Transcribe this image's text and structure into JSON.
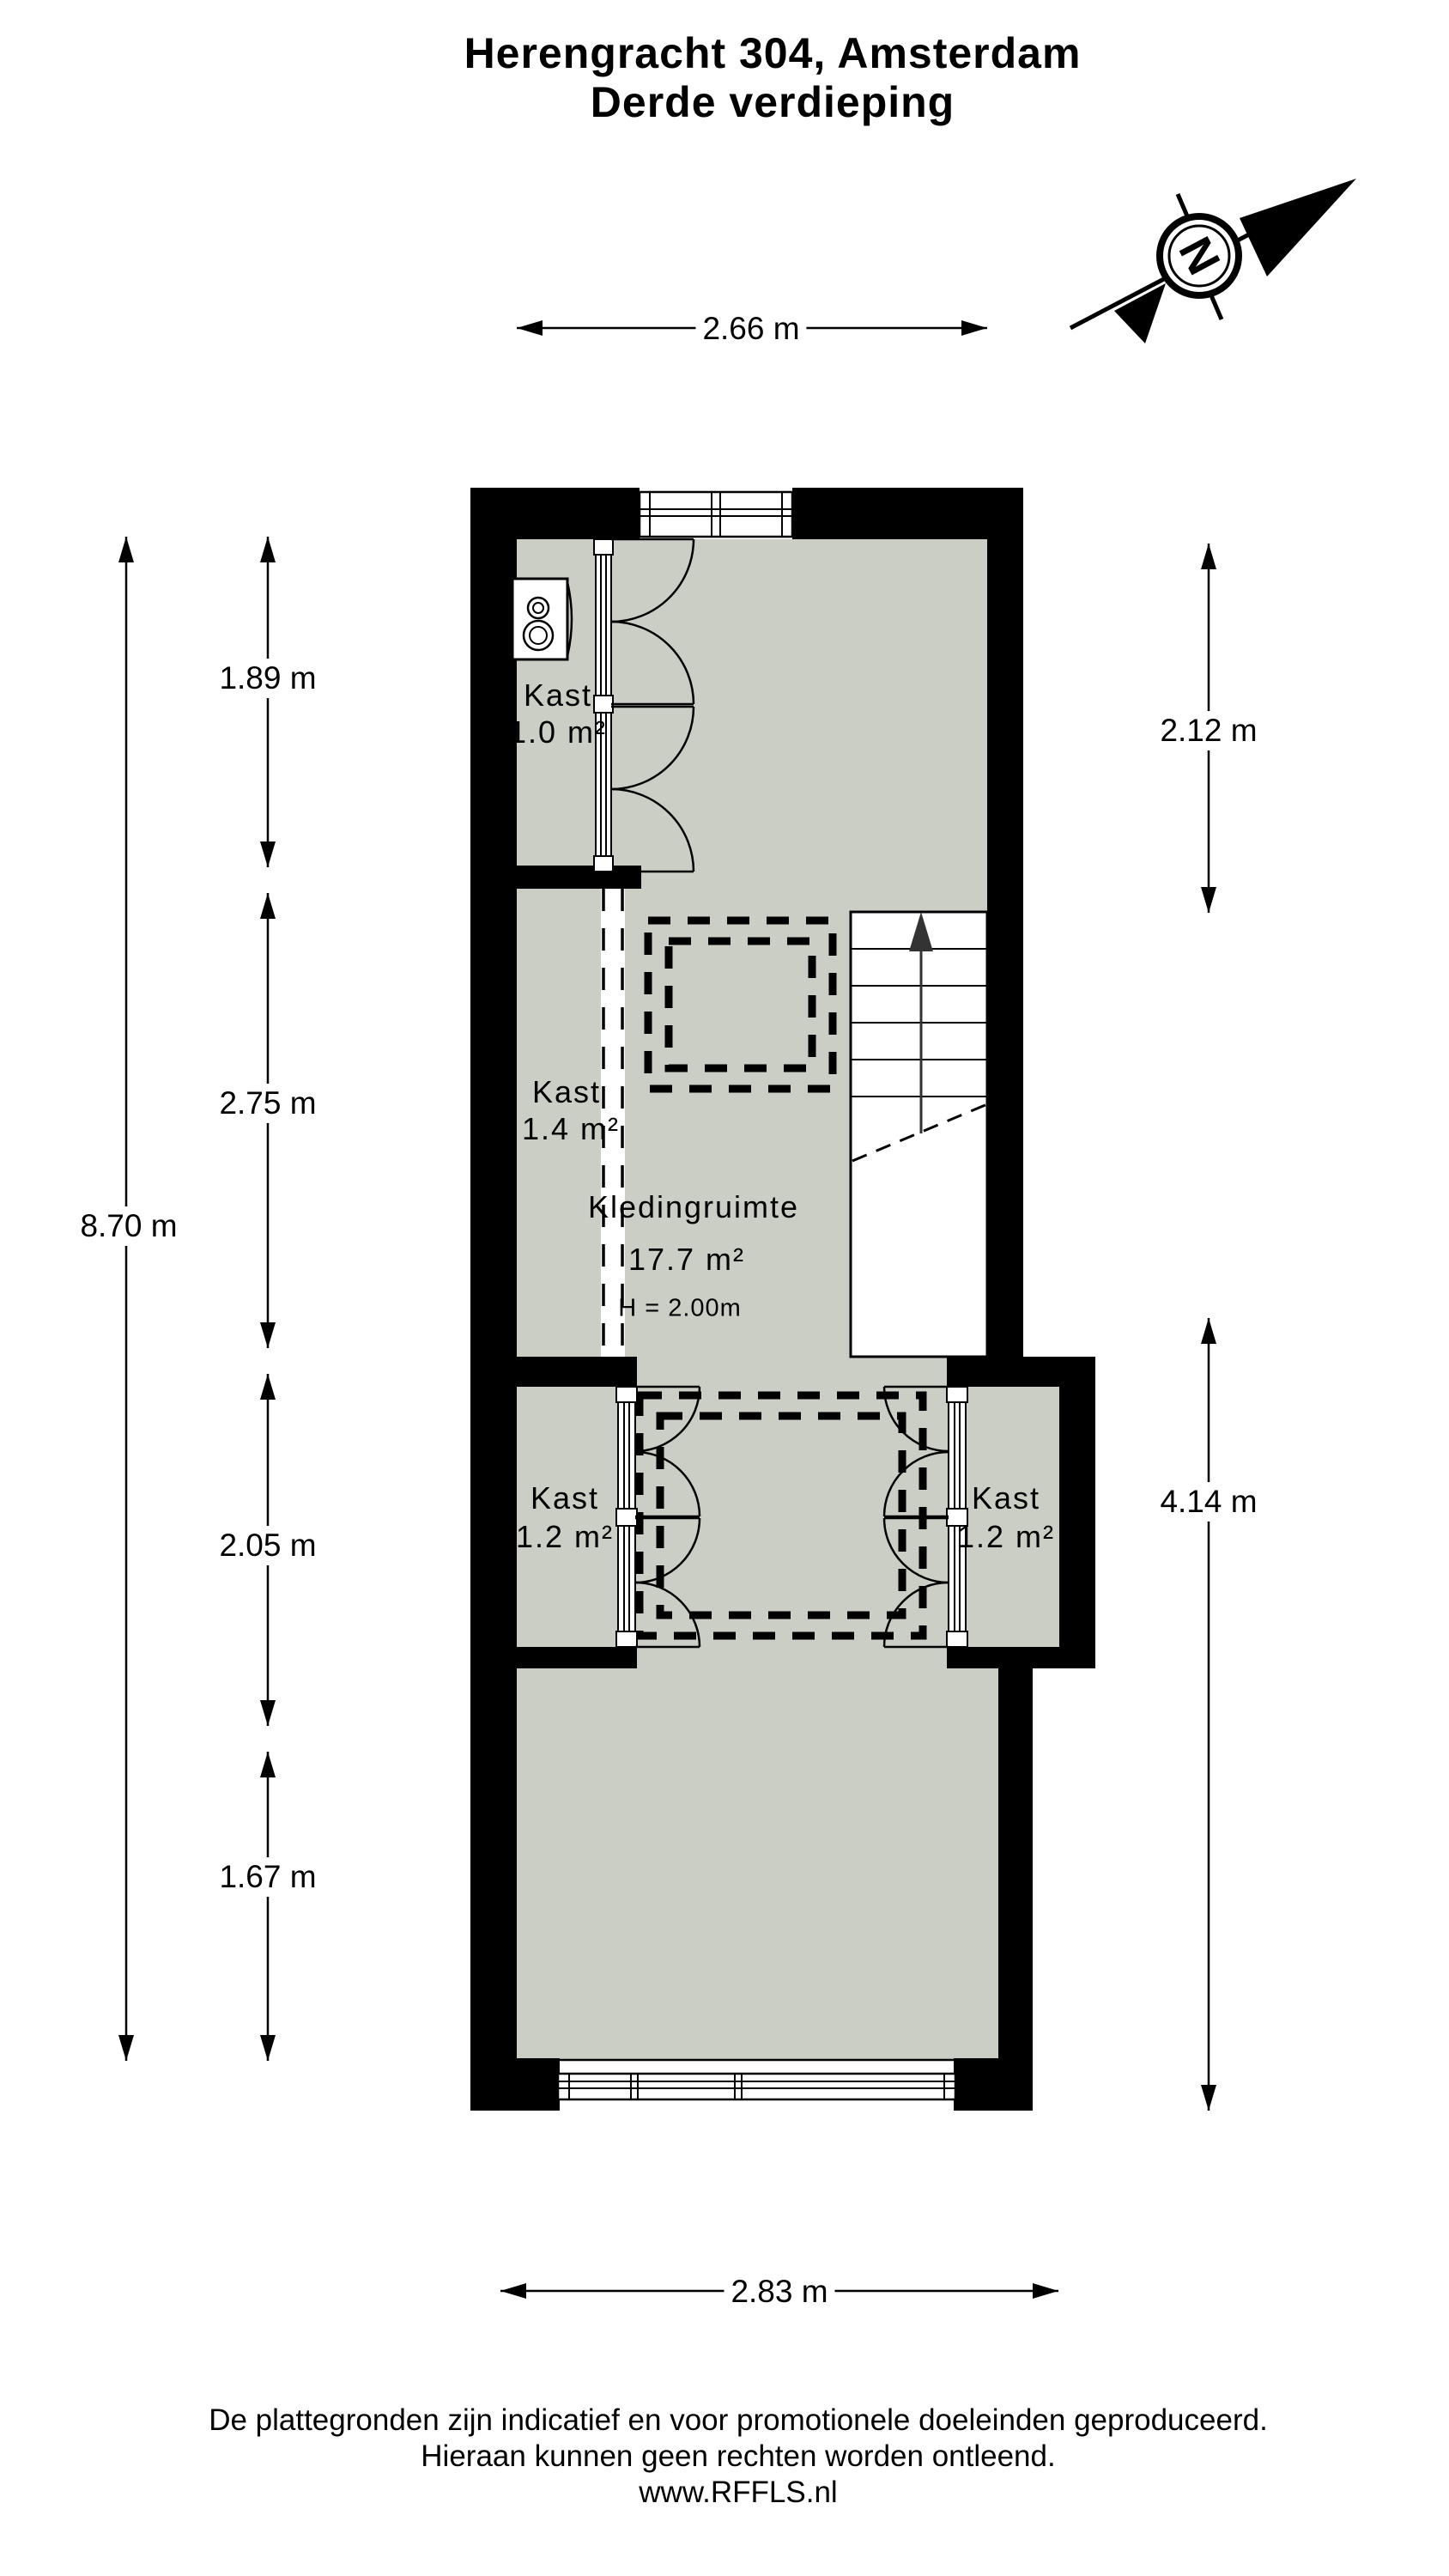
{
  "title": {
    "line1": "Herengracht 304, Amsterdam",
    "line2": "Derde verdieping"
  },
  "compass": {
    "letter": "N"
  },
  "dimensions": {
    "top_width": "2.66 m",
    "bottom_width": "2.83 m",
    "left_total": "8.70 m",
    "left_segments": [
      "1.89 m",
      "2.75 m",
      "2.05 m",
      "1.67 m"
    ],
    "right_top": "2.12 m",
    "right_bottom": "4.14 m"
  },
  "rooms": {
    "kast_top": {
      "name": "Kast",
      "area": "1.0 m²"
    },
    "kast_mid": {
      "name": "Kast",
      "area": "1.4 m²"
    },
    "kledingruimte": {
      "name": "Kledingruimte",
      "area": "17.7 m²",
      "height": "H = 2.00m"
    },
    "kast_bottom_left": {
      "name": "Kast",
      "area": "1.2 m²"
    },
    "kast_bottom_right": {
      "name": "Kast",
      "area": "1.2 m²"
    }
  },
  "footer": {
    "line1": "De plattegronden zijn indicatief en voor promotionele doeleinden geproduceerd.",
    "line2": "Hieraan kunnen geen rechten worden ontleend.",
    "line3": "www.RFFLS.nl"
  },
  "colors": {
    "wall": "#000000",
    "floor": "#cbcec5",
    "background": "#ffffff"
  }
}
